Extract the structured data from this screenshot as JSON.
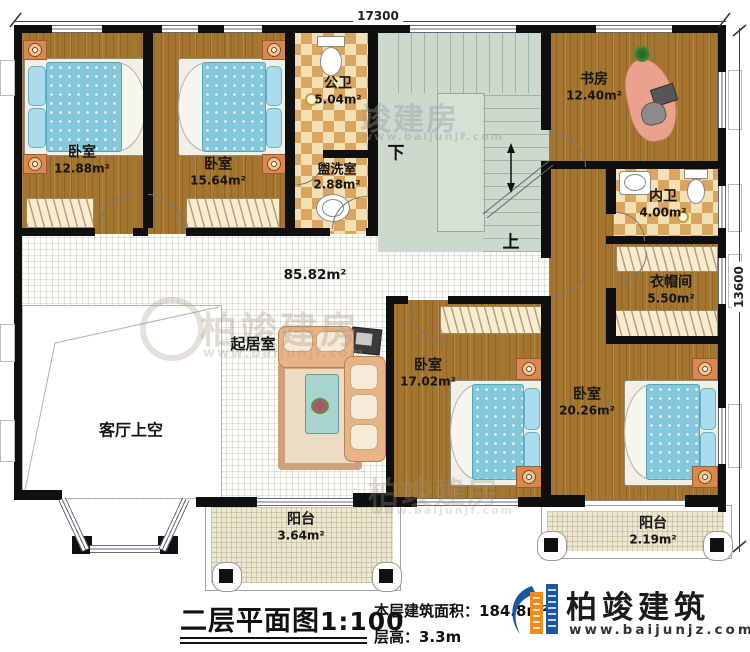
{
  "plan": {
    "dimensions": {
      "top": "17300",
      "right": "13600"
    },
    "stairs": {
      "down_label": "下",
      "up_label": "上"
    },
    "rooms": {
      "bedroom_tl": {
        "label": "卧室",
        "area": "12.88m²"
      },
      "bedroom_tm": {
        "label": "卧室",
        "area": "15.64m²"
      },
      "public_bath": {
        "label": "公卫",
        "area": "5.04m²"
      },
      "washroom": {
        "label": "盥洗室",
        "area": "2.88m²"
      },
      "study": {
        "label": "书房",
        "area": "12.40m²"
      },
      "inner_bath": {
        "label": "内卫",
        "area": "4.00m²"
      },
      "cloakroom": {
        "label": "衣帽间",
        "area": "5.50m²"
      },
      "hall": {
        "area": "85.82m²"
      },
      "living_room": {
        "label": "起居室"
      },
      "living_void": {
        "label": "客厅上空"
      },
      "bedroom_c": {
        "label": "卧室",
        "area": "17.02m²"
      },
      "bedroom_d": {
        "label": "卧室",
        "area": "20.26m²"
      },
      "balcony_center": {
        "label": "阳台",
        "area": "3.64m²"
      },
      "balcony_right": {
        "label": "阳台",
        "area": "2.19m²"
      }
    }
  },
  "titleblock": {
    "title": "二层平面图",
    "scale": "1:100",
    "area_label": "本层建筑面积：184.8m²",
    "floor_height_label": "层高：3.3m"
  },
  "brand": {
    "name": "柏竣建筑",
    "website": "www.baijunjz.com"
  },
  "watermark": {
    "name": "柏竣建房",
    "short": "竣建房",
    "website": "www.baijunjf.com"
  },
  "colors": {
    "wall": "#0f0f0f",
    "wood": "#a3752e",
    "tile_light": "#f3e0b4",
    "tile_dark": "#d9a55f",
    "stair": "#ccd9cc",
    "hall": "#fdfdfa",
    "balcony": "#ece7d0",
    "bed": "#85c8dc",
    "logo_blue": "#1a57a0",
    "logo_orange": "#f08c1e"
  }
}
